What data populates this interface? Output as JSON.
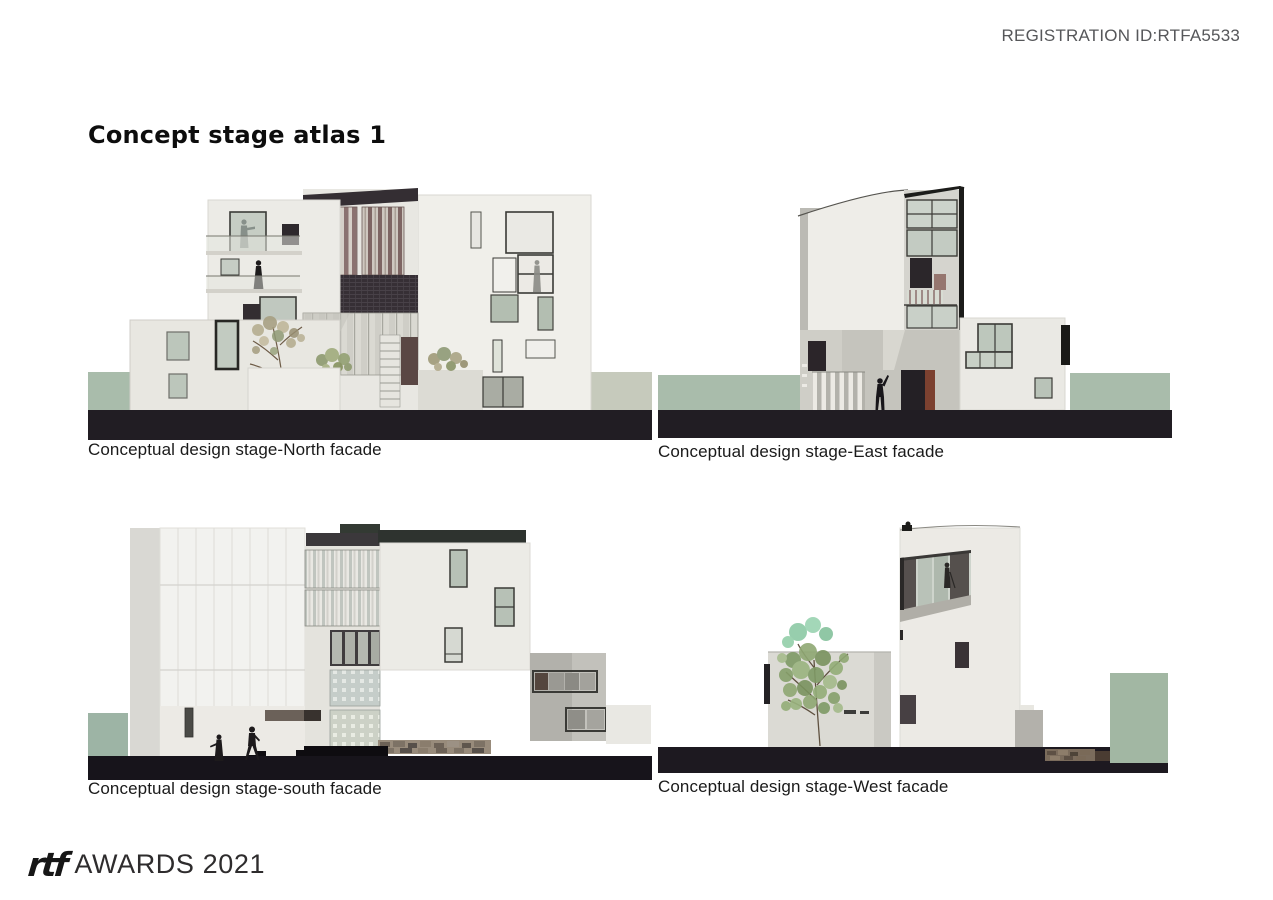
{
  "header": {
    "registration_id": "REGISTRATION ID:RTFA5533"
  },
  "title": "Concept stage atlas 1",
  "panels": {
    "north": {
      "caption": "Conceptual design stage-North facade"
    },
    "east": {
      "caption": "Conceptual design stage-East facade"
    },
    "south": {
      "caption": "Conceptual design stage-south facade"
    },
    "west": {
      "caption": "Conceptual design stage-West facade"
    }
  },
  "footer": {
    "logo_text": "rtf",
    "awards_text": "AWARDS 2021"
  },
  "colors": {
    "ground_band": "#1d1920",
    "sage_green": "#a9bcab",
    "gray_green": "#c6cabc",
    "wall_white": "#ebeae5",
    "charcoal_roof": "#332d33",
    "brick_mauve": "#8b7270",
    "russet_door": "#7c4130",
    "tree_olive": "#8fa873",
    "tree_mint": "#8cc9a5",
    "caption_text": "#1a1a1a",
    "registration_text": "#56575a"
  }
}
